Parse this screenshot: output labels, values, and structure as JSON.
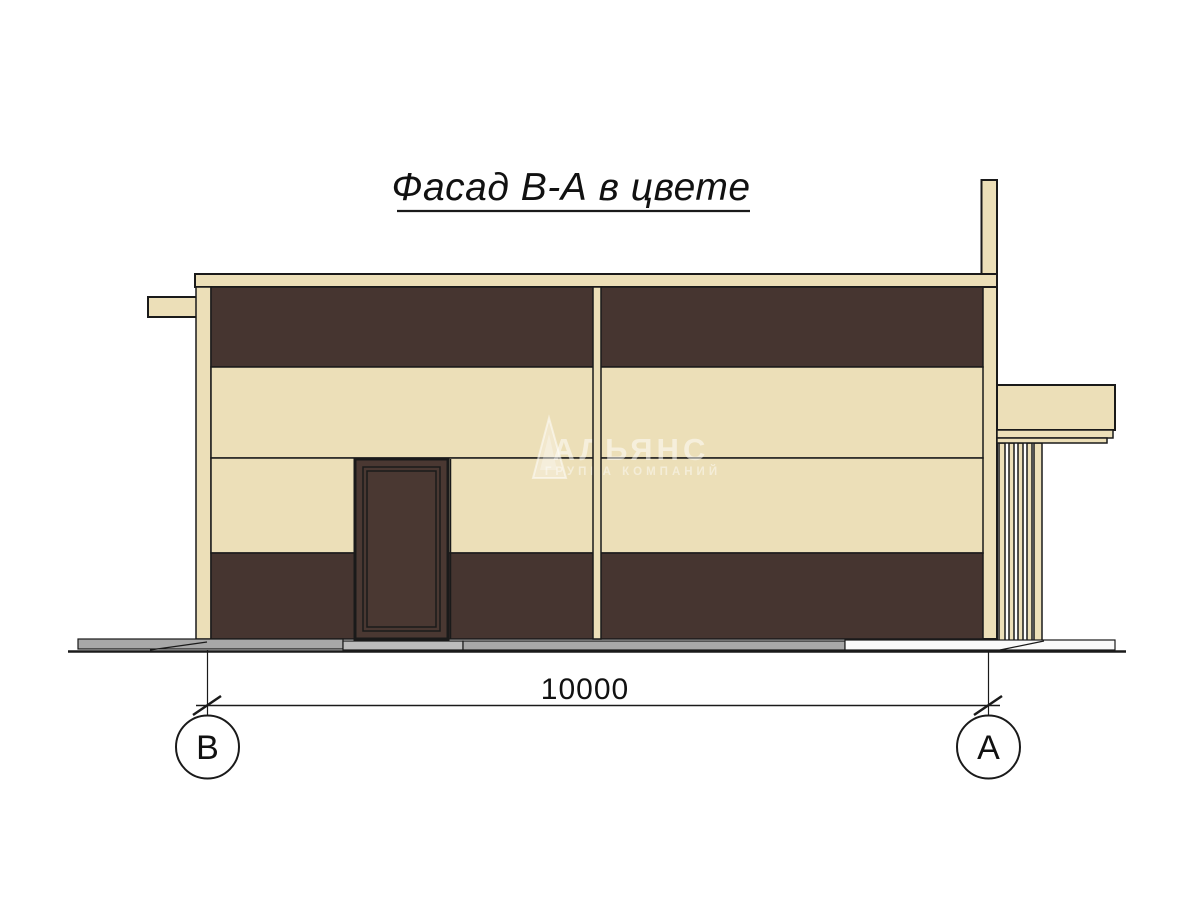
{
  "title": {
    "text": "Фасад В-А в цвете"
  },
  "drawing": {
    "dimension_label": "10000",
    "grid_left_label": "В",
    "grid_right_label": "А"
  },
  "watermark": {
    "logo_icon": "sail-triangle-icon",
    "name": "АЛЬЯНС",
    "subtitle": "ГРУППА КОМПАНИЙ"
  },
  "colors": {
    "cream": "#ecdfb8",
    "dark_brown": "#463530",
    "door_brown": "#4a3832",
    "outline": "#1a1a1a",
    "pavement_gray": "#a8a8a8",
    "pavement_light": "#bcbcbc",
    "pavement_white": "#fafafa",
    "ink": "#111111"
  }
}
